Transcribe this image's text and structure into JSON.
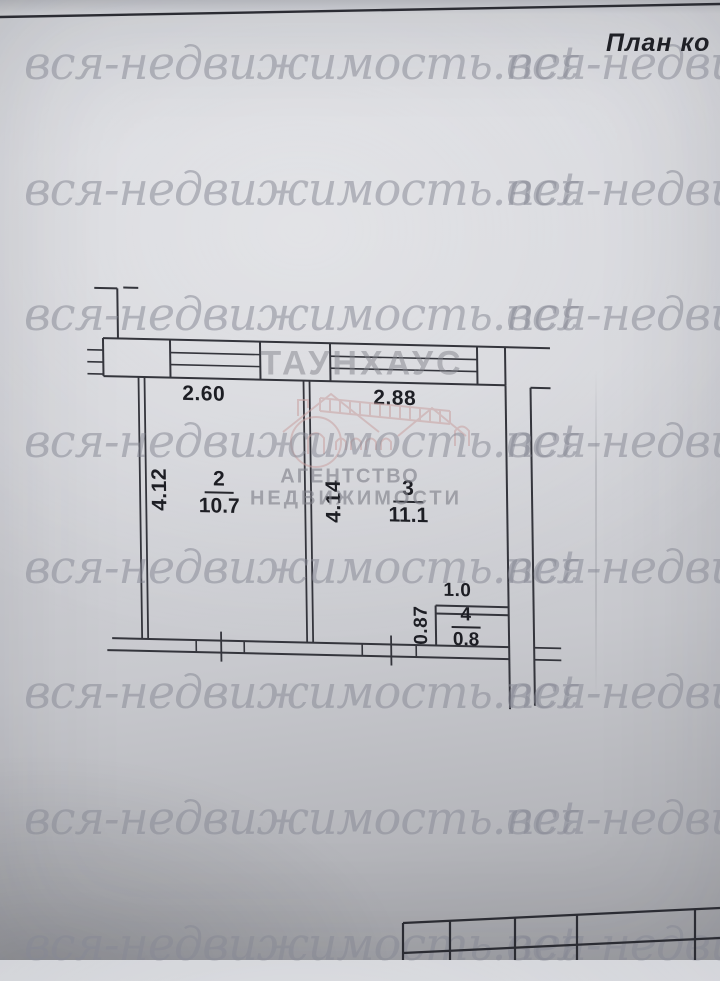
{
  "header": {
    "title_visible": "План ко"
  },
  "watermark": {
    "text": "вся-недвижимость.net"
  },
  "agency_logo": {
    "name": "ТАУНХАУС",
    "subtitle_line1": "АГЕНТСТВО",
    "subtitle_line2": "НЕДВИЖИМОСТИ"
  },
  "floor_plan": {
    "rooms": [
      {
        "number": "2",
        "area": "10.7",
        "top_dim": "2.60",
        "side_dim": "4.12"
      },
      {
        "number": "3",
        "area": "11.1",
        "top_dim": "2.88",
        "side_dim": "4.14"
      },
      {
        "number": "4",
        "area": "0.8",
        "top_dim": "1.0",
        "side_dim": "0.87"
      }
    ]
  },
  "colors": {
    "drawing_line": "#34353c",
    "watermark_gray": "#878995",
    "logo_pink": "#c9a2a2",
    "label_text": "#1d1e24"
  }
}
